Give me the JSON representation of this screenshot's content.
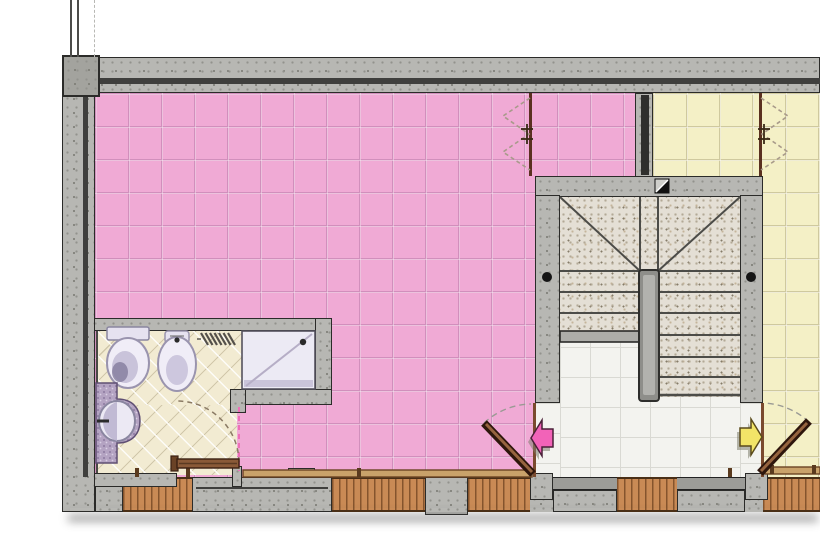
{
  "document": {
    "type": "architectural-floor-plan",
    "view": "top-down plan of apartment level with stairwell",
    "visible_text_labels": []
  },
  "palette": {
    "pink_floor": "#F0AAD5",
    "yellow_floor": "#F4F0C6",
    "landing_floor": "#F3F3EF",
    "bathroom_floor": "#F2EBD2",
    "concrete_wall": "#B7B7B3",
    "wall_outline": "#2B2B29",
    "brick_sill": "#C98A55",
    "granite_stair": "#E4DFD5",
    "wood_door": "#8A5A38",
    "door_leaf_dark": "#2E160C",
    "counter_granite": "#B4A3C2",
    "fixture_white": "#F0EDF7",
    "pink_arrow": "#F263B8",
    "pink_arrow_outline": "#4A2038",
    "yellow_arrow": "#F2E468",
    "yellow_arrow_outline": "#5A4A1A"
  },
  "rooms": [
    {
      "id": "living-room-pink",
      "floor": "pink square tiles",
      "position": "left large room"
    },
    {
      "id": "apartment-yellow",
      "floor": "yellow square tiles",
      "position": "right room, partially cropped"
    },
    {
      "id": "bathroom",
      "floor": "beige diagonal tiles",
      "position": "bottom left",
      "fixtures": [
        "toilet",
        "bidet",
        "radiator",
        "shower-tray-with-drain",
        "washbasin-on-granite-counter"
      ]
    },
    {
      "id": "stairwell",
      "position": "center right",
      "features": [
        "u-shaped-staircase",
        "winder-treads",
        "central-spine-wall",
        "section-cut-symbol",
        "handrail-anchor-dots"
      ]
    },
    {
      "id": "entrance-landing",
      "floor": "white tiles",
      "position": "bottom of stairwell"
    }
  ],
  "doors": [
    {
      "id": "pink-apartment-entry-door",
      "type": "hinged",
      "swing": "opens into pink room",
      "arrow": "pink arrow pointing left"
    },
    {
      "id": "yellow-apartment-entry-door",
      "type": "hinged",
      "swing": "opens into yellow room",
      "arrow": "yellow arrow pointing right"
    },
    {
      "id": "bathroom-door",
      "type": "hinged",
      "swing": "opens into bathroom"
    },
    {
      "id": "pink-folding-door",
      "type": "accordion",
      "shown": "dashed zigzag symbol"
    },
    {
      "id": "yellow-folding-door",
      "type": "accordion",
      "shown": "dashed zigzag symbol"
    }
  ],
  "windows": [
    {
      "id": "bathroom-window",
      "sill": "brick hatch, bottom wall left"
    },
    {
      "id": "pink-room-windows",
      "sill": "brick hatch with concrete pier, bottom wall center"
    },
    {
      "id": "landing-window",
      "sill": "brick hatch, below stairwell landing"
    },
    {
      "id": "yellow-room-window",
      "sill": "brick hatch, bottom wall right"
    }
  ],
  "symbols": [
    {
      "id": "section-cut-marker",
      "shape": "black/white diagonal square on stairwell top wall"
    },
    {
      "id": "wall-continuation-lines",
      "shape": "thin vertical lines above top-left column"
    }
  ]
}
